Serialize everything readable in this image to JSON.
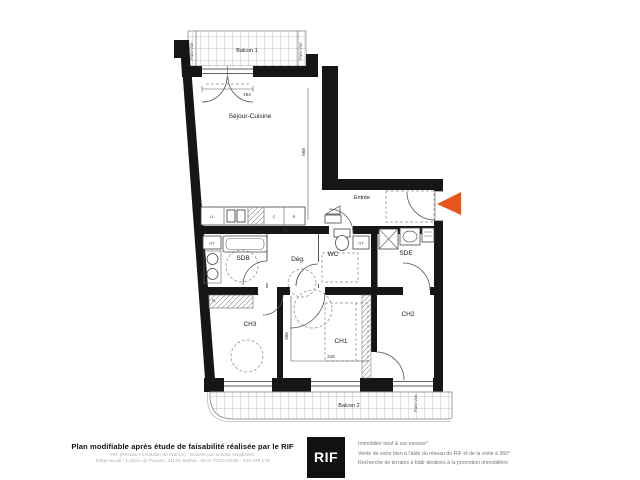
{
  "plan": {
    "balcony1_label": "Balcon 1",
    "balcony2_label": "Balcon 2",
    "pare_vue": "Pare-Vue",
    "rooms": {
      "sejour": "Séjour-Cuisine",
      "entree": "Entrée",
      "sdb": "SDB",
      "deg": "Dég.",
      "wc": "WC",
      "sde": "SDE",
      "ch1": "CH1",
      "ch2": "CH2",
      "ch3": "CH3"
    },
    "dims": {
      "sejour_width": "484",
      "sejour_depth": "568",
      "ch1_width": "315",
      "ch1_depth": "306"
    },
    "kitchen": {
      "ll": "LL",
      "c": "C",
      "r": "R"
    },
    "tags": {
      "gt": "GT",
      "pl": "PL"
    },
    "colors": {
      "arrow": "#E8551C",
      "wall": "#161616"
    }
  },
  "footer": {
    "left_bold": "Plan modifiable après étude de faisabilité réalisée par le RIF",
    "left_line1": "RIF (Réseau Immobilier de France) - Société par actions simplifiées",
    "left_line2": "Siège social : 1 place de Pavans, 31130, Balma - RCS TOULOUSE - 538 236 178",
    "logo": "RIF",
    "right_line1": "Immobilier neuf & sur-mesure*",
    "right_line2": "Vente de votre bien à l'aide du réseau du RIF et de la visite à 360°",
    "right_line3": "Recherche de terrains à bâtir destinés à la promotion immobilière"
  }
}
